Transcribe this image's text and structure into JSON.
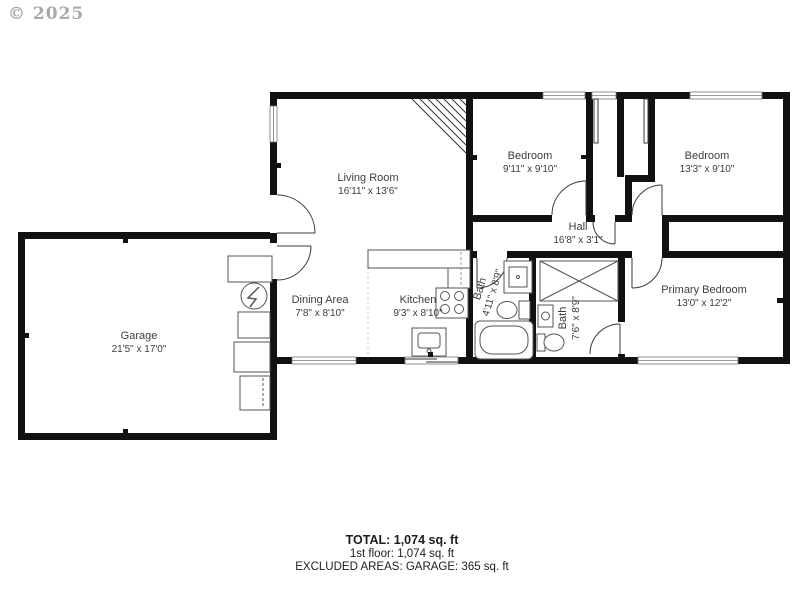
{
  "watermark": "© 2025",
  "rooms": {
    "living": {
      "name": "Living Room",
      "dims": "16'11\" x 13'6\""
    },
    "bedroom1": {
      "name": "Bedroom",
      "dims": "9'11\" x 9'10\""
    },
    "bedroom2": {
      "name": "Bedroom",
      "dims": "13'3\" x 9'10\""
    },
    "hall": {
      "name": "Hall",
      "dims": "16'8\" x 3'1\""
    },
    "dining": {
      "name": "Dining Area",
      "dims": "7'8\" x 8'10\""
    },
    "kitchen": {
      "name": "Kitchen",
      "dims": "9'3\" x 8'10\""
    },
    "bath1": {
      "name": "Bath",
      "dims": "4'11\" x 8'9\""
    },
    "bath2": {
      "name": "Bath",
      "dims": "7'6\" x 8'9\""
    },
    "primary": {
      "name": "Primary Bedroom",
      "dims": "13'0\" x 12'2\""
    },
    "garage": {
      "name": "Garage",
      "dims": "21'5\" x 17'0\""
    }
  },
  "summary": {
    "total": "TOTAL: 1,074 sq. ft",
    "first_floor": "1st floor: 1,074  sq. ft",
    "excluded": "EXCLUDED AREAS: GARAGE: 365 sq. ft"
  },
  "colors": {
    "wall": "#111111",
    "label": "#3d3d3d",
    "window_line": "#777777",
    "fixture_line": "#555555",
    "watermark": "#a8a8a8"
  }
}
